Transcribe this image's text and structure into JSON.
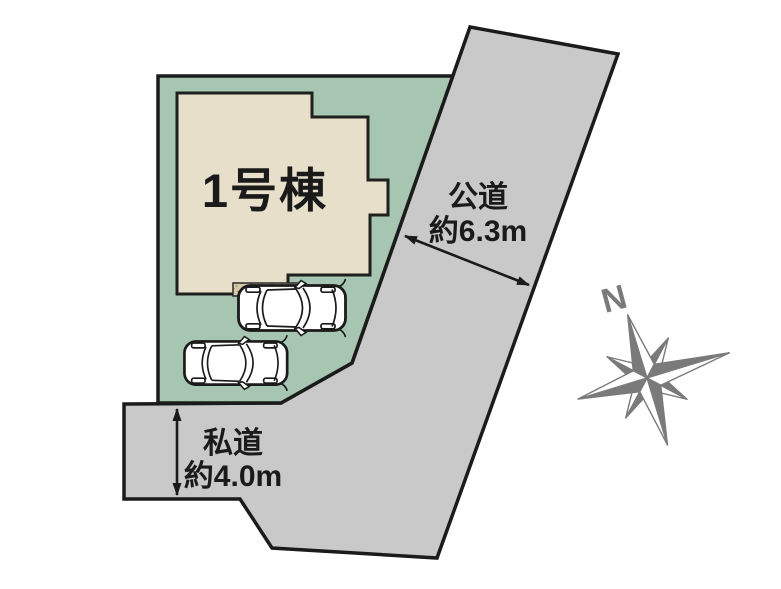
{
  "diagram": {
    "building": {
      "label": "1号棟"
    },
    "public_road": {
      "name": "公道",
      "width": "約6.3m"
    },
    "private_road": {
      "name": "私道",
      "width": "約4.0m"
    },
    "compass": {
      "north": "N"
    }
  },
  "colors": {
    "plot_green": "#a7c6b1",
    "building_beige": "#e7dfc9",
    "road_gray": "#c9c9c9",
    "strip_tan": "#d6c9a6",
    "outline_black": "#1b1b1b",
    "compass_gray": "#7a7a7a",
    "background": "#ffffff"
  }
}
